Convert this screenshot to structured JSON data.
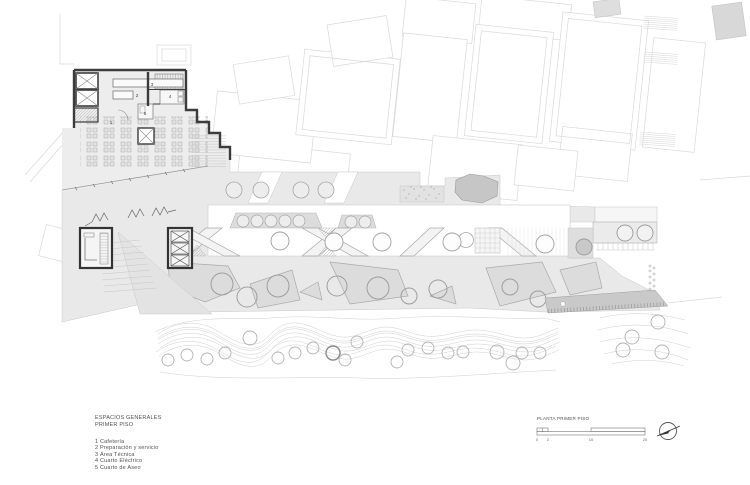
{
  "legend": {
    "title_lines": [
      "ESPACIOS GENERALES",
      "PRIMER PISO"
    ],
    "items": [
      "1 Cafetería",
      "2 Preparación y servicio",
      "3 Área Técnica",
      "4 Cuarto Eléctrico",
      "5 Cuarto de Aseo"
    ]
  },
  "title_block": {
    "label": "PLANTA PRIMER PISO",
    "scale_ticks": [
      "0",
      "2",
      "10",
      "20"
    ]
  },
  "plan": {
    "room_numbers": [
      "1",
      "2",
      "3",
      "4",
      "5"
    ]
  },
  "colors": {
    "wall": "#3c3c3c",
    "plaza_fill": "#e9e9e9",
    "context_line": "#d9d9d9",
    "tree_line": "#b0b0b0",
    "annotation_text": "#4f4f4f"
  }
}
